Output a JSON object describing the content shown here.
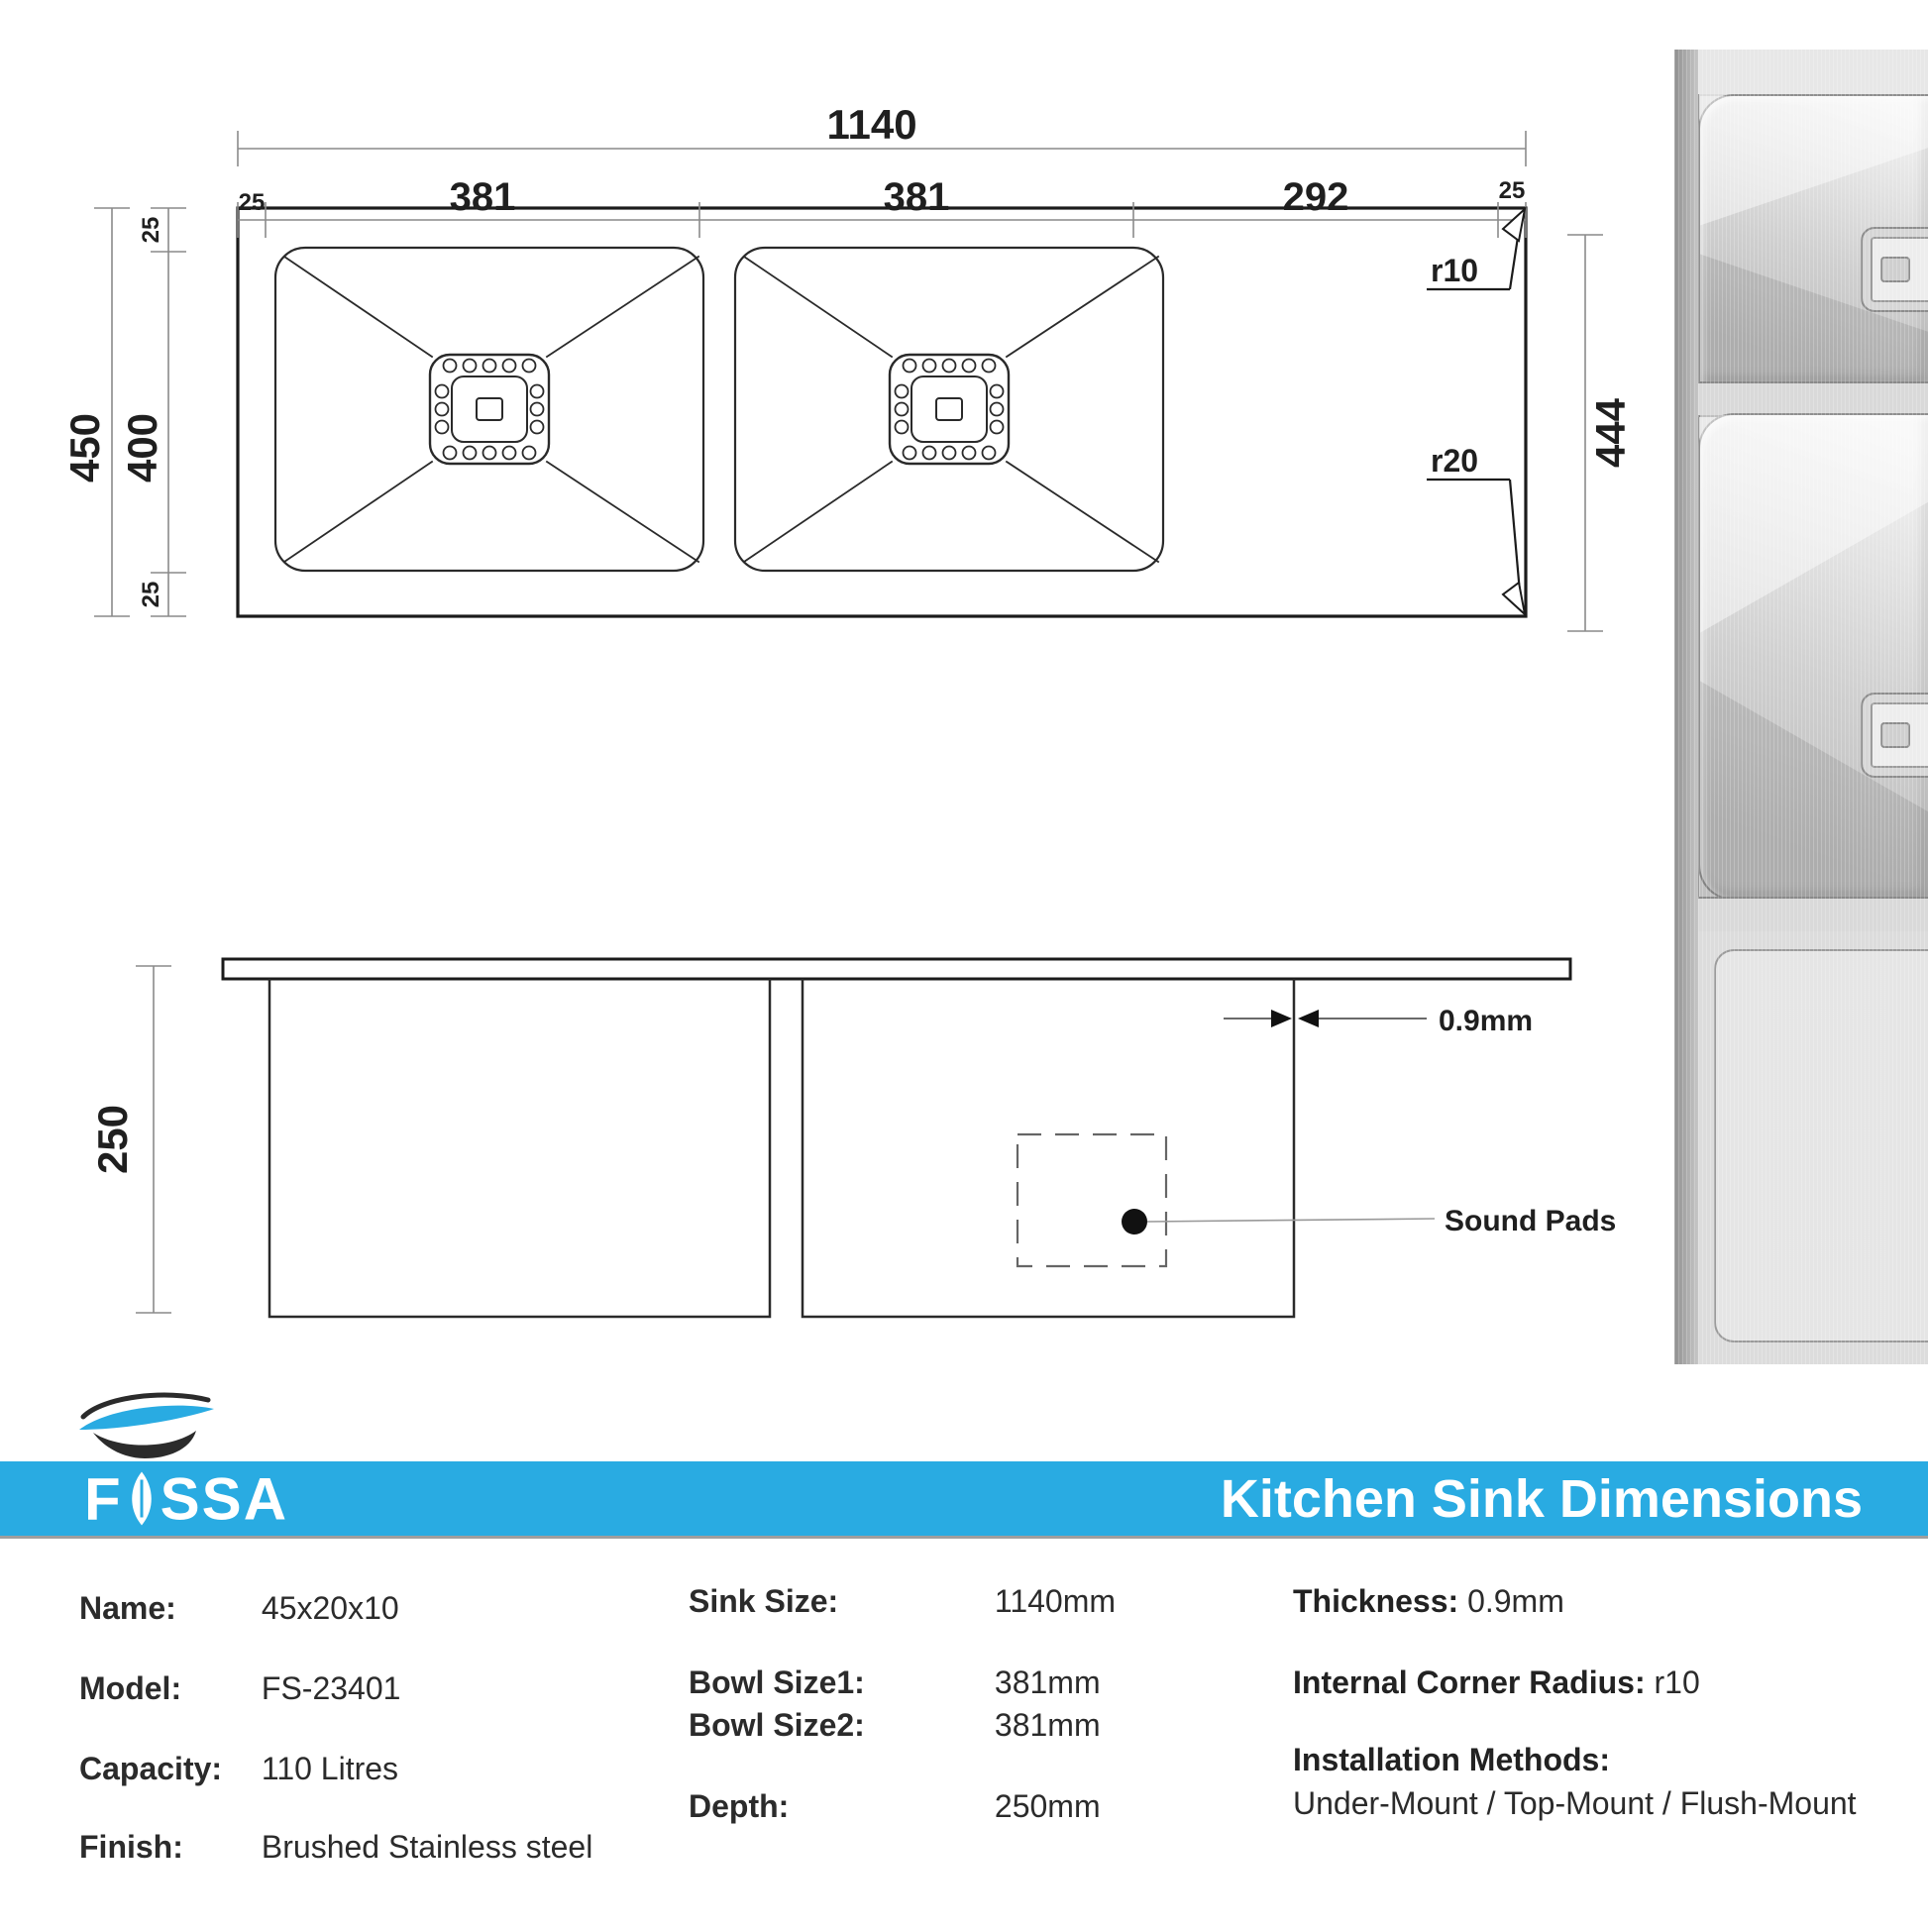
{
  "colors": {
    "accent": "#29ABE2"
  },
  "drawing": {
    "top_view": {
      "overall_width": "1140",
      "left_margin": "25",
      "bowl1_width": "381",
      "bowl2_width": "381",
      "right_section": "292",
      "right_margin": "25",
      "overall_height": "450",
      "inner_height": "400",
      "top_margin": "25",
      "bottom_margin": "25",
      "right_height": "444",
      "radius_top": "r10",
      "radius_bottom": "r20"
    },
    "side_view": {
      "depth": "250",
      "thickness": "0.9mm",
      "sound_pads": "Sound Pads"
    }
  },
  "branding": {
    "logo_text_f": "F",
    "logo_text_ssa": "SSA",
    "header_title": "Kitchen Sink Dimensions"
  },
  "specs": {
    "left": [
      {
        "label": "Name:",
        "value": "45x20x10"
      },
      {
        "label": "Model:",
        "value": "FS-23401"
      },
      {
        "label": "Capacity:",
        "value": "110 Litres"
      },
      {
        "label": "Finish:",
        "value": "Brushed Stainless steel"
      }
    ],
    "middle": [
      {
        "label": "Sink Size:",
        "value": "1140mm"
      },
      {
        "label": "Bowl Size1:",
        "value": "381mm"
      },
      {
        "label": "Bowl Size2:",
        "value": "381mm"
      },
      {
        "label": "Depth:",
        "value": "250mm"
      }
    ],
    "right": {
      "thickness_label": "Thickness:",
      "thickness_value": " 0.9mm",
      "radius_label": "Internal Corner Radius:",
      "radius_value": " r10",
      "install_label": "Installation Methods:",
      "install_value": "Under-Mount / Top-Mount / Flush-Mount"
    }
  }
}
